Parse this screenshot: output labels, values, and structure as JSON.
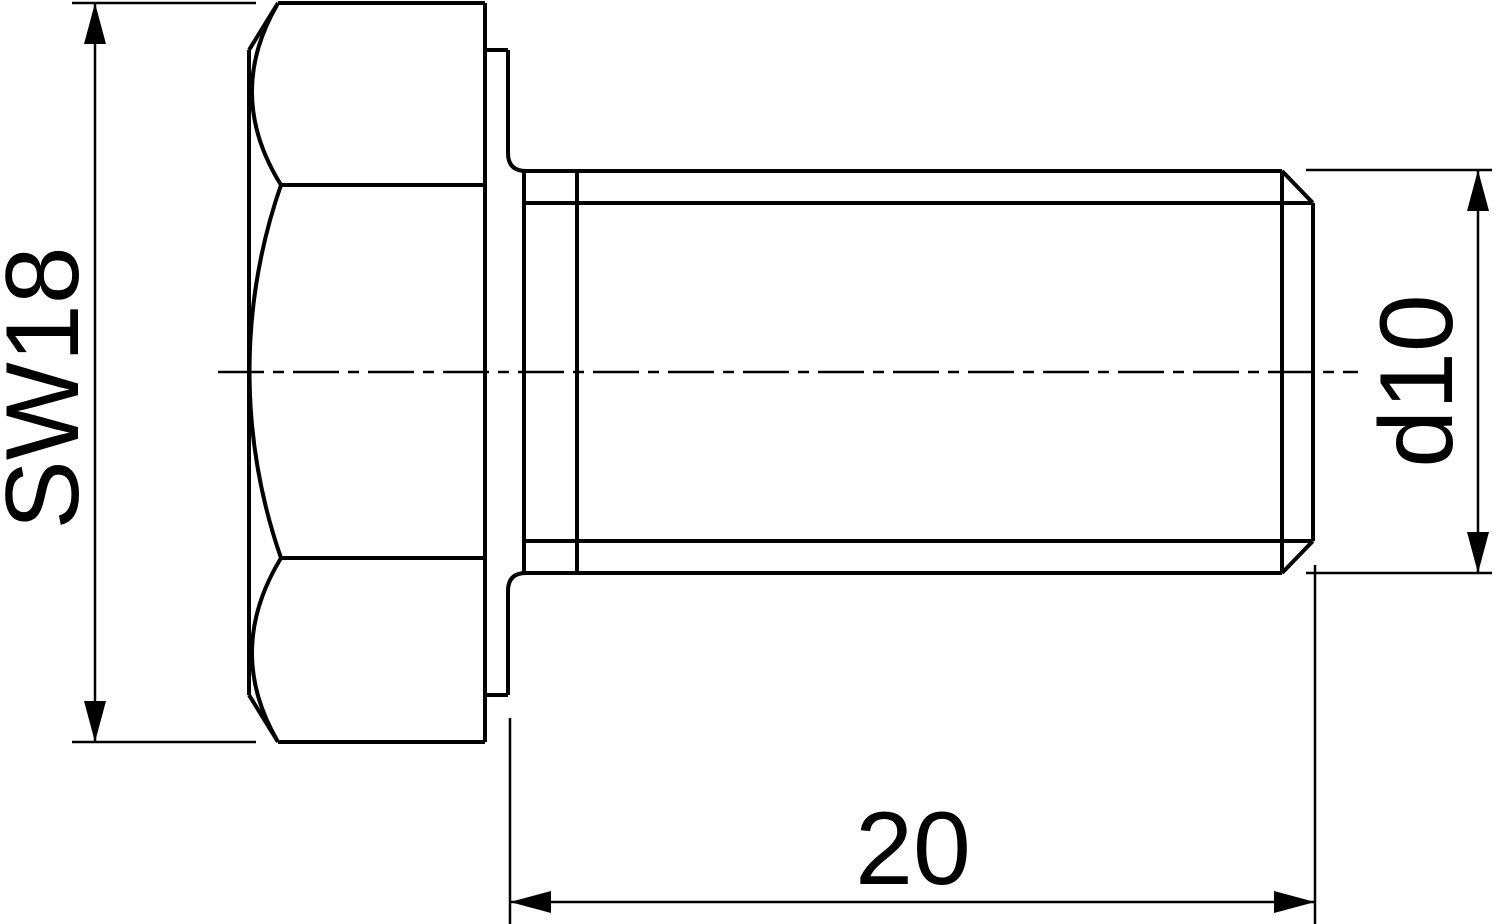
{
  "drawing": {
    "background": "#ffffff",
    "line_color": "#000000",
    "dimensions": {
      "across_flats": {
        "label": "SW18"
      },
      "diameter": {
        "label": "d10"
      },
      "length": {
        "label": "20"
      }
    }
  }
}
